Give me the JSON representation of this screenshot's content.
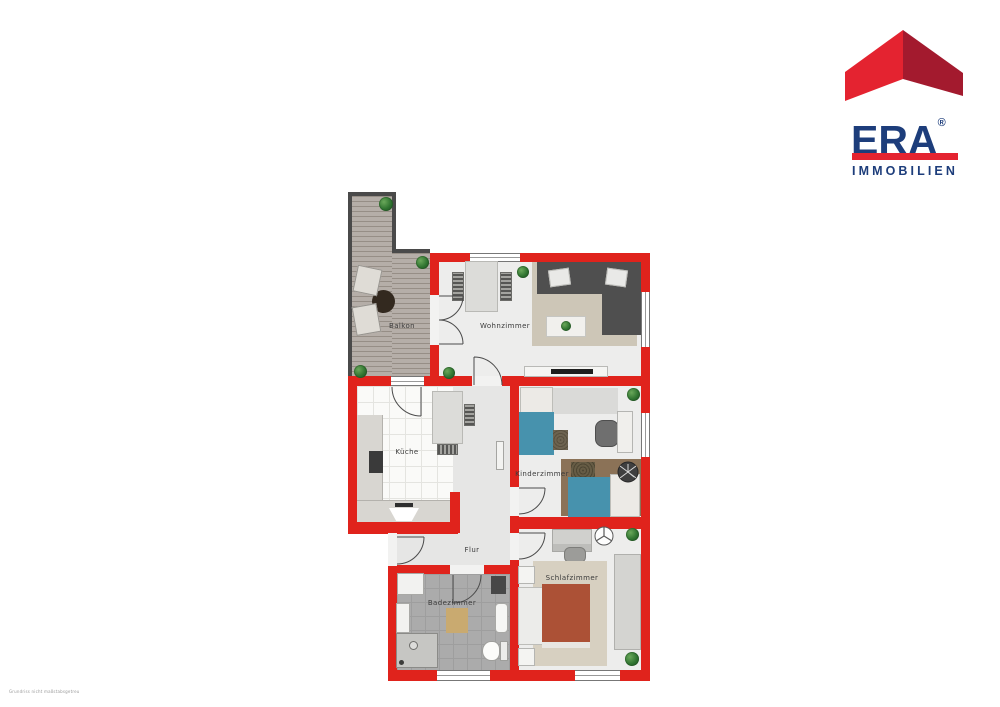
{
  "logo": {
    "brand": "ERA",
    "registered": "®",
    "subtitle": "IMMOBILIEN"
  },
  "rooms": {
    "balkon": {
      "label": "Balkon"
    },
    "wohnzimmer": {
      "label": "Wohnzimmer"
    },
    "kueche": {
      "label": "Küche"
    },
    "kinderzimmer": {
      "label": "Kinderzimmer"
    },
    "flur": {
      "label": "Flur"
    },
    "badezimmer": {
      "label": "Badezimmer"
    },
    "schlafzimmer": {
      "label": "Schlafzimmer"
    }
  },
  "watermark": "Grundriss nicht maßstabsgetreu",
  "colors": {
    "wall_red": "#e0231c",
    "balcony_wall": "#4a4a4a",
    "logo_red": "#e42330",
    "logo_red_dark": "#a31a2e",
    "logo_navy": "#1d3d7b",
    "bed_teal": "#4792ad",
    "bed_rust": "#ac5136",
    "sofa_gray": "#4f4f4f",
    "rug_beige": "#cdc6b7",
    "rug_brown": "#8b7257",
    "bath_tile": "#ababab",
    "deck_wood": "#b5aea8"
  }
}
